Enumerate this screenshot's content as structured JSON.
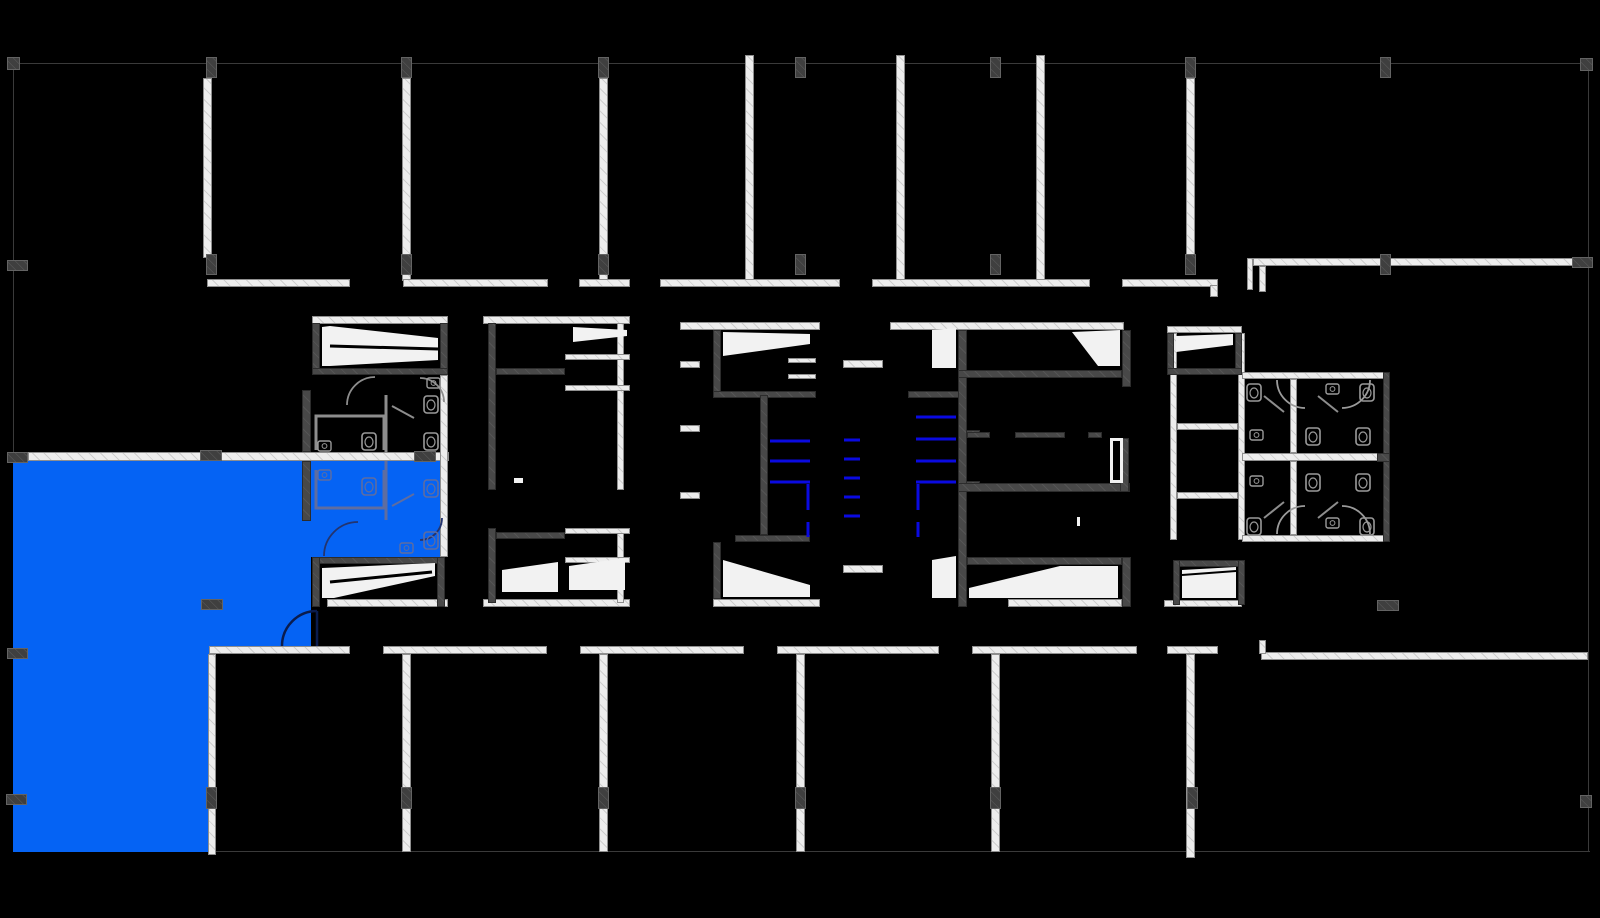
{
  "meta": {
    "drawing_type": "architectural floor plan",
    "description": "Office floor plate with central service core, north and south room bands, east wing, and one highlighted tenant suite",
    "canvas": {
      "width": 1600,
      "height": 918
    }
  },
  "colors": {
    "background": "#000000",
    "grid_line": "#3a3a3a",
    "wall_light": "#ededed",
    "wall_dark": "#484848",
    "column_marker": "#3f3f3f",
    "suite_highlight": "#0563F4",
    "elevator_door_line": "#0a0ae1",
    "fixture_outline": "#9b9b9b",
    "fixture_outline_on_blue": "#5f6da0",
    "door_arc_on_blue": "#0a1c4e",
    "stair_tread": "#f2f2f2"
  },
  "regions": {
    "suite": {
      "label": "Highlighted suite (selected availability)",
      "color": "#0563F4"
    },
    "north_band": {
      "label": "North perimeter room band"
    },
    "south_band": {
      "label": "South perimeter room band"
    },
    "core": {
      "label": "Central building core"
    },
    "east_wing": {
      "label": "East wing open area"
    },
    "core_restrooms_west": {
      "label": "West core restrooms (within suite)"
    },
    "core_restrooms_east": {
      "label": "East core restrooms"
    }
  },
  "features": {
    "stair_shaft_boxes": 10,
    "elevator_banks": 2,
    "elevator_door_marks_west_bank": 3,
    "elevator_door_marks_east_bank": 4,
    "center_shaft_marks": 5,
    "restroom_groups": 3,
    "column_markers": 32,
    "structural_grid_columns": 9,
    "structural_grid_rows": 5
  }
}
